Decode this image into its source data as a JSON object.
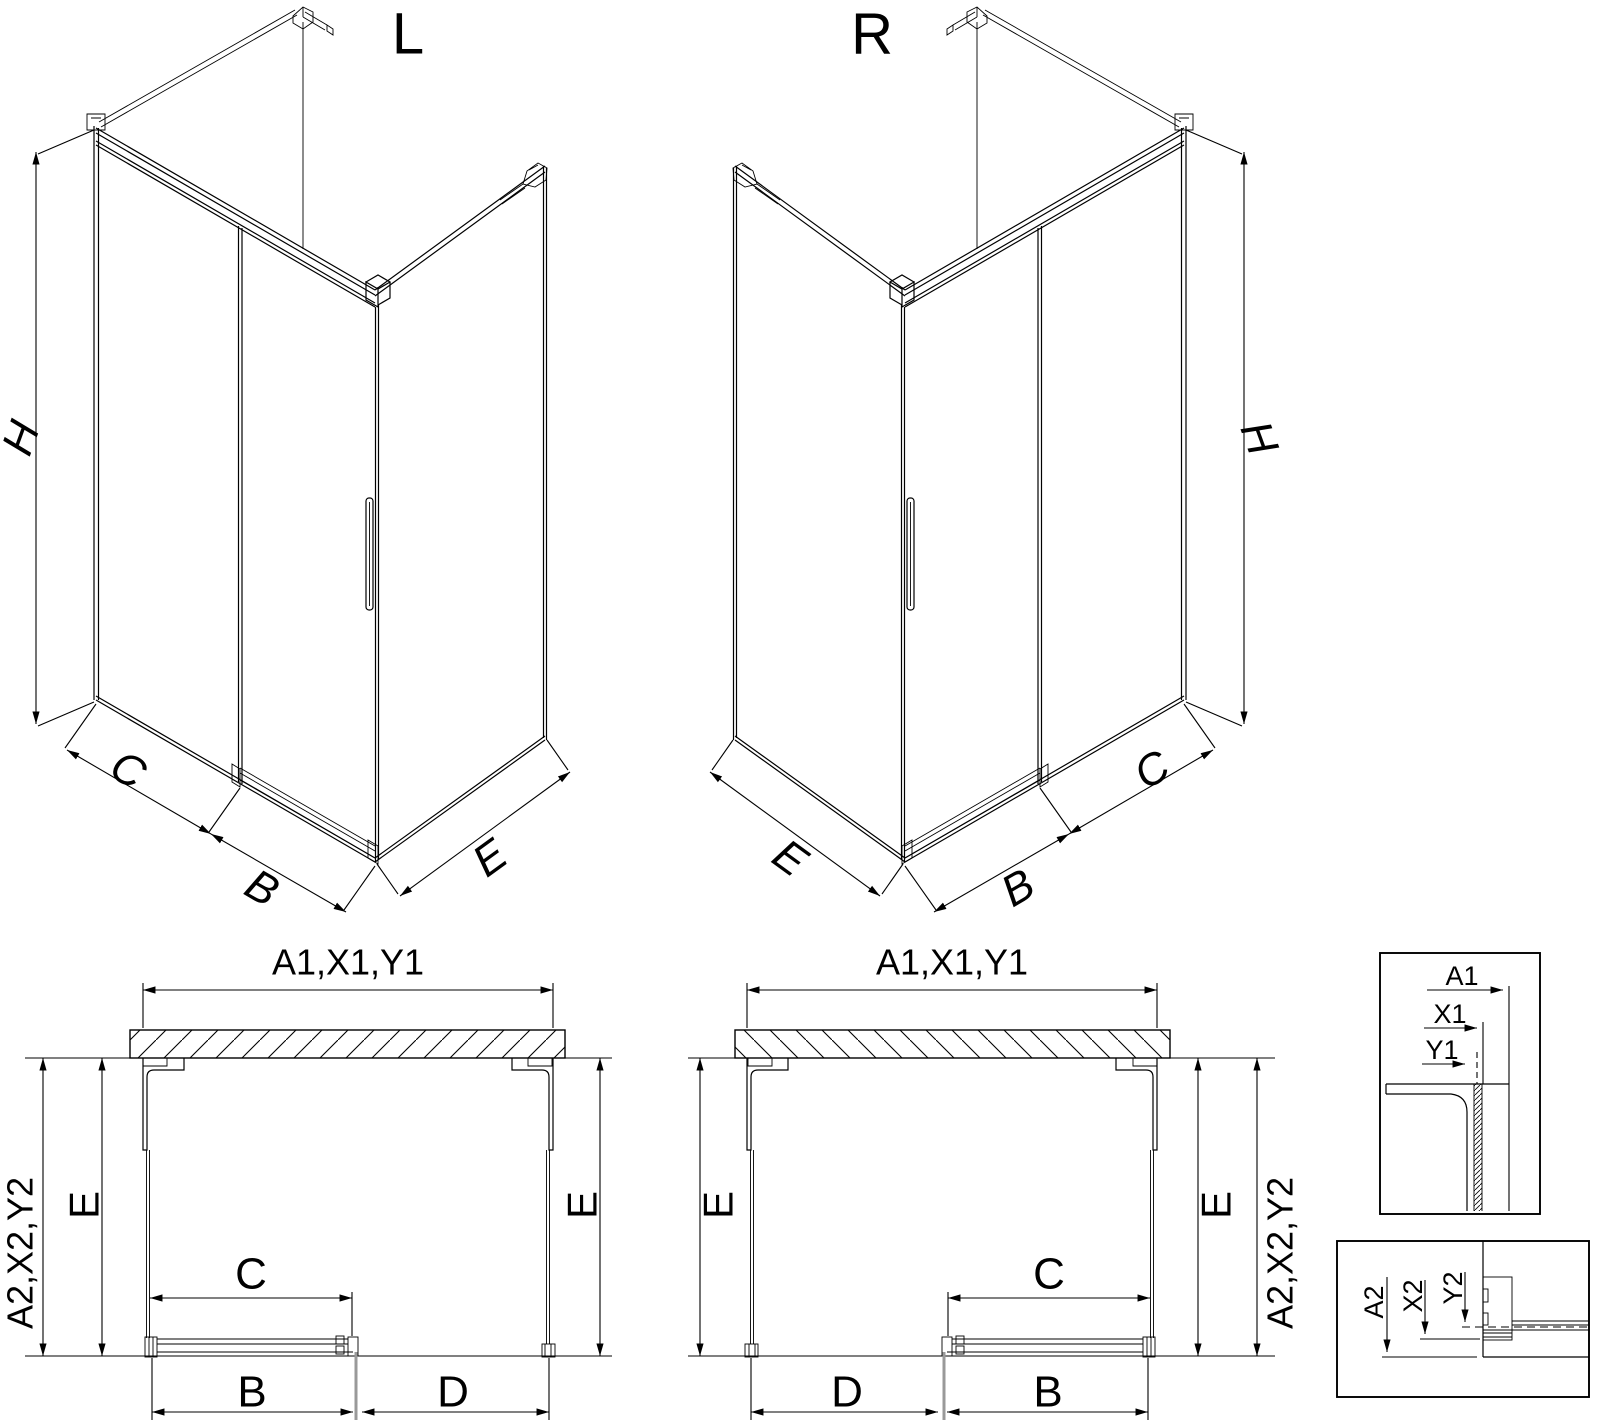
{
  "drawing": {
    "type": "technical-cad-drawing",
    "subject": "corner shower enclosure with sliding door, left and right variants",
    "colors": {
      "background": "#ffffff",
      "line": "#000000",
      "door_edge_gray": "#999999"
    },
    "views": {
      "iso_left": {
        "title": "L",
        "dim_height": "H",
        "dim_fixed": "C",
        "dim_door": "B",
        "dim_side": "E"
      },
      "iso_right": {
        "title": "R",
        "dim_height": "H",
        "dim_fixed": "C",
        "dim_door": "B",
        "dim_side": "E"
      },
      "plan_left": {
        "dim_width_top": "A1,X1,Y1",
        "dim_depth_outer": "A2,X2,Y2",
        "dim_e_left": "E",
        "dim_e_right": "E",
        "dim_opening": "C",
        "dim_door": "B",
        "dim_fixed": "D"
      },
      "plan_right": {
        "dim_width_top": "A1,X1,Y1",
        "dim_depth_outer": "A2,X2,Y2",
        "dim_e_left": "E",
        "dim_e_right": "E",
        "dim_opening": "C",
        "dim_door": "B",
        "dim_fixed": "D"
      },
      "detail_top": {
        "dim_a": "A1",
        "dim_x": "X1",
        "dim_y": "Y1"
      },
      "detail_bottom": {
        "dim_a": "A2",
        "dim_x": "X2",
        "dim_y": "Y2"
      }
    }
  }
}
